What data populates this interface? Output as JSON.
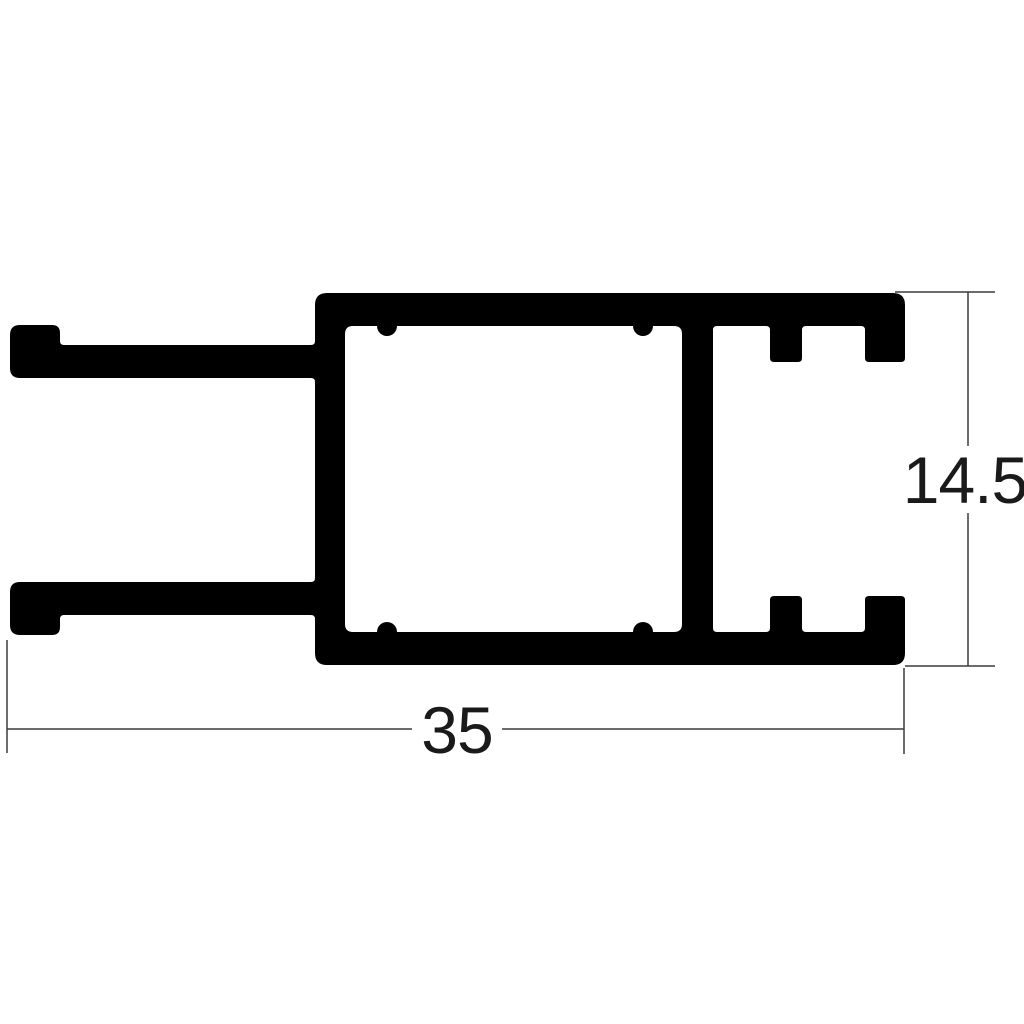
{
  "drawing": {
    "dimensions": {
      "width_label": "35",
      "height_label": "14.5"
    },
    "colors": {
      "profile_fill": "#000000",
      "dimension_line": "#3c3c3c",
      "label_text": "#1a1a1a",
      "background": "#ffffff"
    }
  }
}
